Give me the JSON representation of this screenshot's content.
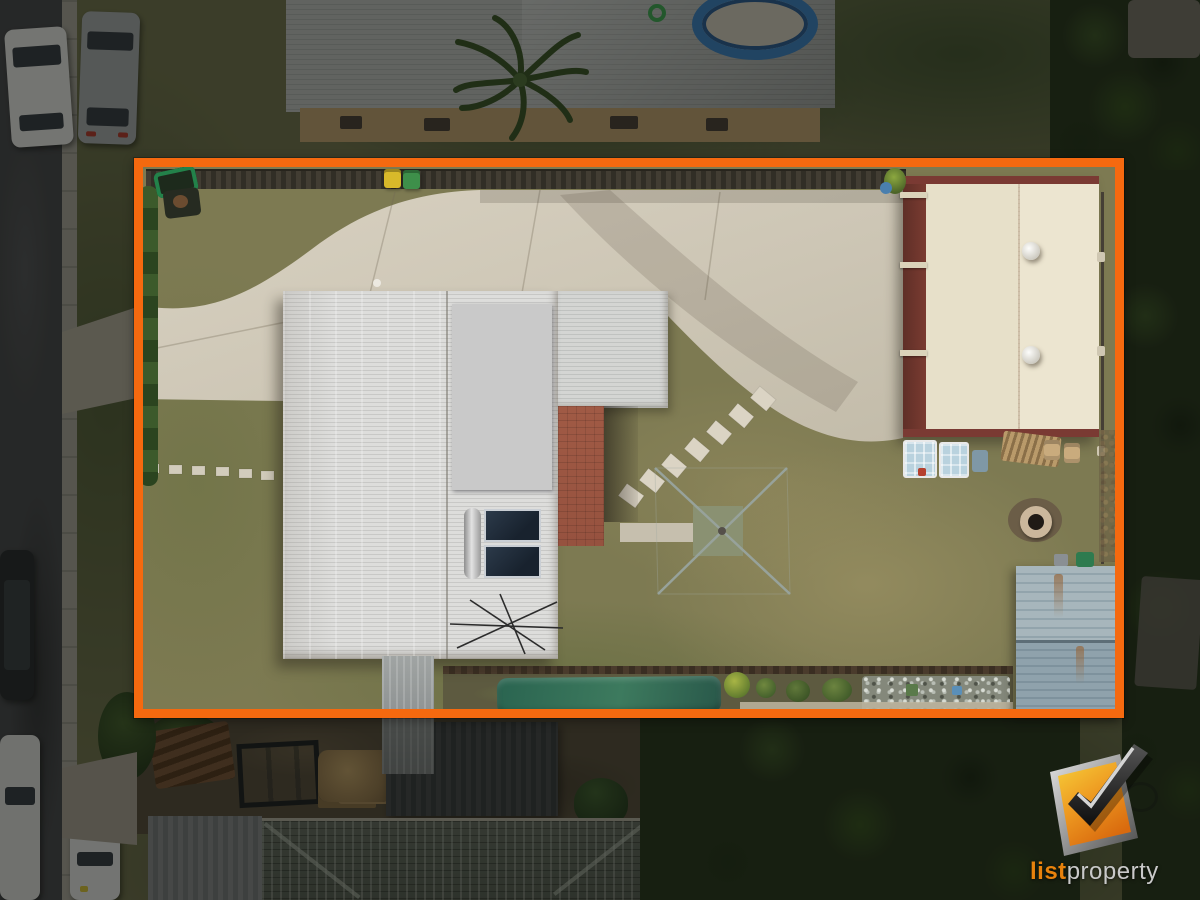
{
  "watermark": {
    "brand_prefix": "list",
    "brand_suffix": "property"
  },
  "boundary": {
    "color": "#f5690f"
  },
  "palette": {
    "boundary_orange": "#f5690f",
    "logo_orange": "#e8820c",
    "logo_grey": "#c9c9c9",
    "road_asphalt": "#46474b",
    "concrete_driveway": "#cec7b6",
    "lawn_olive": "#7d7a52",
    "house_roof_white": "#d9d9d7",
    "solar_panel_blue": "#2b4a74",
    "shed_roof_cream": "#ece5d0",
    "shed_trim_maroon": "#7a3a33",
    "pool_blue": "#3c82c4",
    "garden_tarp_green": "#2f6b55",
    "old_shed_bluegrey": "#98aab2"
  }
}
